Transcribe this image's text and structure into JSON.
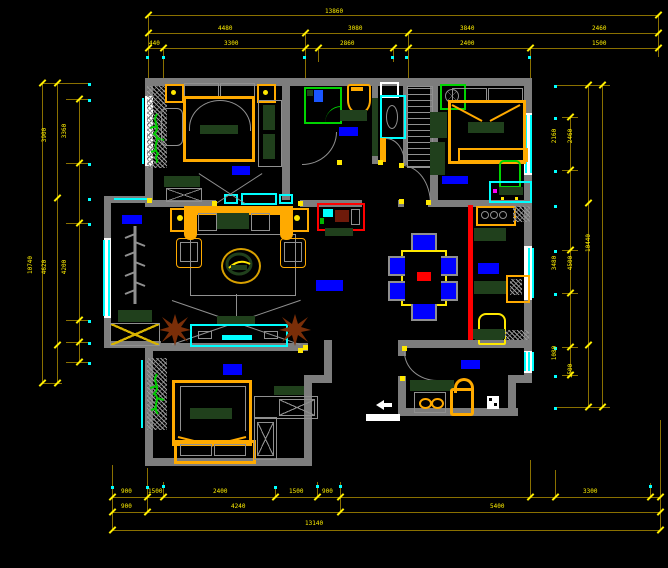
{
  "canvas": {
    "width": 668,
    "height": 568,
    "background": "#000000"
  },
  "drawing_title": "residential-apartment-furniture-floor-plan",
  "colors": {
    "wall": "#7d7d7d",
    "dimension_line": "#8a7000",
    "dimension_text": "#ffef00",
    "window": "#00ffff",
    "room_marker": "#0000ff",
    "cabinet_green": "#20401c",
    "furniture_frame": "#ffaa00",
    "slider_red": "#ff0000",
    "plant_brown": "#7a2e08",
    "plant_green": "#00cc00",
    "white": "#ffffff"
  },
  "rooms": [
    "bedroom-top-left",
    "bathroom",
    "shower-room",
    "closet",
    "bedroom-top-right",
    "balcony",
    "living-room",
    "dining-room",
    "kitchen",
    "bedroom-bottom-left",
    "entry"
  ],
  "markers": [
    {
      "name": "room-marker-bedroom-top-left",
      "x": 232,
      "y": 166,
      "w": 18,
      "h": 9
    },
    {
      "name": "room-marker-bathroom",
      "x": 339,
      "y": 127,
      "w": 19,
      "h": 9
    },
    {
      "name": "room-marker-bedroom-top-right",
      "x": 442,
      "y": 176,
      "w": 26,
      "h": 8
    },
    {
      "name": "room-marker-balcony",
      "x": 122,
      "y": 215,
      "w": 20,
      "h": 9
    },
    {
      "name": "room-marker-living-room",
      "x": 316,
      "y": 280,
      "w": 27,
      "h": 11
    },
    {
      "name": "room-marker-kitchen",
      "x": 478,
      "y": 263,
      "w": 21,
      "h": 11
    },
    {
      "name": "room-marker-bedroom-bottom-left",
      "x": 223,
      "y": 364,
      "w": 19,
      "h": 11
    },
    {
      "name": "room-marker-entry",
      "x": 461,
      "y": 360,
      "w": 19,
      "h": 9
    }
  ],
  "dims": {
    "labels": [
      {
        "text": "13860",
        "x": 325,
        "y": 9
      },
      {
        "text": "4480",
        "x": 218,
        "y": 26
      },
      {
        "text": "3080",
        "x": 348,
        "y": 26
      },
      {
        "text": "3840",
        "x": 460,
        "y": 26
      },
      {
        "text": "2460",
        "x": 592,
        "y": 26
      },
      {
        "text": "440",
        "x": 149,
        "y": 41
      },
      {
        "text": "3300",
        "x": 224,
        "y": 41
      },
      {
        "text": "2860",
        "x": 340,
        "y": 41
      },
      {
        "text": "2400",
        "x": 460,
        "y": 41
      },
      {
        "text": "1500",
        "x": 592,
        "y": 41
      },
      {
        "text": "900",
        "x": 121,
        "y": 489
      },
      {
        "text": "1500",
        "x": 148,
        "y": 489
      },
      {
        "text": "2400",
        "x": 213,
        "y": 489
      },
      {
        "text": "1500",
        "x": 289,
        "y": 489
      },
      {
        "text": "900",
        "x": 322,
        "y": 489
      },
      {
        "text": "3300",
        "x": 583,
        "y": 489
      },
      {
        "text": "900",
        "x": 121,
        "y": 504
      },
      {
        "text": "4240",
        "x": 231,
        "y": 504
      },
      {
        "text": "5400",
        "x": 490,
        "y": 504
      },
      {
        "text": "13140",
        "x": 305,
        "y": 521
      },
      {
        "text": "3900",
        "x": 38,
        "y": 132,
        "rot": -90
      },
      {
        "text": "4620",
        "x": 38,
        "y": 264,
        "rot": -90
      },
      {
        "text": "10740",
        "x": 22,
        "y": 262,
        "rot": -90
      },
      {
        "text": "3360",
        "x": 58,
        "y": 128,
        "rot": -90
      },
      {
        "text": "4200",
        "x": 58,
        "y": 264,
        "rot": -90
      },
      {
        "text": "2160",
        "x": 548,
        "y": 133,
        "rot": -90
      },
      {
        "text": "3480",
        "x": 548,
        "y": 260,
        "rot": -90
      },
      {
        "text": "1080",
        "x": 548,
        "y": 350,
        "rot": -90
      },
      {
        "text": "2460",
        "x": 564,
        "y": 133,
        "rot": -90
      },
      {
        "text": "4500",
        "x": 564,
        "y": 260,
        "rot": -90
      },
      {
        "text": "1500",
        "x": 564,
        "y": 368,
        "rot": -90
      },
      {
        "text": "10440",
        "x": 580,
        "y": 240,
        "rot": -90
      }
    ],
    "ticks": [
      {
        "x": 148,
        "y": 15
      },
      {
        "x": 658,
        "y": 15
      },
      {
        "x": 148,
        "y": 33
      },
      {
        "x": 305,
        "y": 33
      },
      {
        "x": 408,
        "y": 33
      },
      {
        "x": 658,
        "y": 33
      },
      {
        "x": 148,
        "y": 48
      },
      {
        "x": 163,
        "y": 48
      },
      {
        "x": 305,
        "y": 48
      },
      {
        "x": 318,
        "y": 48
      },
      {
        "x": 393,
        "y": 48
      },
      {
        "x": 408,
        "y": 48
      },
      {
        "x": 530,
        "y": 48
      },
      {
        "x": 658,
        "y": 48
      },
      {
        "x": 112,
        "y": 497
      },
      {
        "x": 147,
        "y": 497
      },
      {
        "x": 163,
        "y": 497
      },
      {
        "x": 275,
        "y": 497
      },
      {
        "x": 317,
        "y": 497
      },
      {
        "x": 340,
        "y": 497
      },
      {
        "x": 530,
        "y": 497
      },
      {
        "x": 555,
        "y": 497
      },
      {
        "x": 650,
        "y": 497
      },
      {
        "x": 660,
        "y": 497
      },
      {
        "x": 112,
        "y": 512
      },
      {
        "x": 147,
        "y": 512
      },
      {
        "x": 340,
        "y": 512
      },
      {
        "x": 660,
        "y": 512
      },
      {
        "x": 112,
        "y": 530
      },
      {
        "x": 660,
        "y": 530
      },
      {
        "x": 42,
        "y": 83
      },
      {
        "x": 42,
        "y": 383
      },
      {
        "x": 57,
        "y": 83
      },
      {
        "x": 57,
        "y": 198
      },
      {
        "x": 57,
        "y": 345
      },
      {
        "x": 57,
        "y": 383
      },
      {
        "x": 79,
        "y": 99
      },
      {
        "x": 79,
        "y": 163
      },
      {
        "x": 79,
        "y": 223
      },
      {
        "x": 79,
        "y": 320
      },
      {
        "x": 79,
        "y": 342
      },
      {
        "x": 79,
        "y": 362
      },
      {
        "x": 588,
        "y": 85
      },
      {
        "x": 588,
        "y": 203
      },
      {
        "x": 588,
        "y": 345
      },
      {
        "x": 588,
        "y": 407
      },
      {
        "x": 602,
        "y": 85
      },
      {
        "x": 602,
        "y": 407
      },
      {
        "x": 570,
        "y": 117
      },
      {
        "x": 570,
        "y": 170
      },
      {
        "x": 570,
        "y": 250
      },
      {
        "x": 570,
        "y": 293
      },
      {
        "x": 570,
        "y": 347
      },
      {
        "x": 570,
        "y": 375
      }
    ],
    "dots": [
      {
        "x": 146,
        "y": 56
      },
      {
        "x": 162,
        "y": 56
      },
      {
        "x": 303,
        "y": 56
      },
      {
        "x": 391,
        "y": 56
      },
      {
        "x": 405,
        "y": 56
      },
      {
        "x": 528,
        "y": 56
      },
      {
        "x": 111,
        "y": 486
      },
      {
        "x": 146,
        "y": 486
      },
      {
        "x": 162,
        "y": 485
      },
      {
        "x": 274,
        "y": 486
      },
      {
        "x": 316,
        "y": 485
      },
      {
        "x": 339,
        "y": 485
      },
      {
        "x": 649,
        "y": 485
      },
      {
        "x": 88,
        "y": 83
      },
      {
        "x": 88,
        "y": 99
      },
      {
        "x": 88,
        "y": 163
      },
      {
        "x": 88,
        "y": 198
      },
      {
        "x": 88,
        "y": 223
      },
      {
        "x": 88,
        "y": 320
      },
      {
        "x": 88,
        "y": 342
      },
      {
        "x": 88,
        "y": 362
      },
      {
        "x": 554,
        "y": 85
      },
      {
        "x": 554,
        "y": 117
      },
      {
        "x": 554,
        "y": 170
      },
      {
        "x": 554,
        "y": 205
      },
      {
        "x": 554,
        "y": 250
      },
      {
        "x": 554,
        "y": 293
      },
      {
        "x": 554,
        "y": 347
      },
      {
        "x": 554,
        "y": 375
      },
      {
        "x": 554,
        "y": 407
      }
    ],
    "stubs": [
      {
        "x": 148,
        "y": 15,
        "w": 1,
        "h": 63
      },
      {
        "x": 305,
        "y": 33,
        "w": 1,
        "h": 45
      },
      {
        "x": 408,
        "y": 33,
        "w": 1,
        "h": 45
      },
      {
        "x": 163,
        "y": 48,
        "w": 1,
        "h": 32
      },
      {
        "x": 318,
        "y": 48,
        "w": 1,
        "h": 14
      },
      {
        "x": 393,
        "y": 48,
        "w": 1,
        "h": 14
      },
      {
        "x": 530,
        "y": 48,
        "w": 1,
        "h": 30
      },
      {
        "x": 658,
        "y": 15,
        "w": 1,
        "h": 42
      },
      {
        "x": 112,
        "y": 465,
        "w": 1,
        "h": 65
      },
      {
        "x": 147,
        "y": 468,
        "w": 1,
        "h": 44
      },
      {
        "x": 163,
        "y": 482,
        "w": 1,
        "h": 15
      },
      {
        "x": 275,
        "y": 488,
        "w": 1,
        "h": 9
      },
      {
        "x": 317,
        "y": 482,
        "w": 1,
        "h": 15
      },
      {
        "x": 340,
        "y": 482,
        "w": 1,
        "h": 30
      },
      {
        "x": 530,
        "y": 460,
        "w": 1,
        "h": 37
      },
      {
        "x": 555,
        "y": 470,
        "w": 1,
        "h": 27
      },
      {
        "x": 650,
        "y": 483,
        "w": 1,
        "h": 14
      },
      {
        "x": 660,
        "y": 420,
        "w": 1,
        "h": 110
      },
      {
        "x": 66,
        "y": 99,
        "w": 24,
        "h": 1
      },
      {
        "x": 66,
        "y": 163,
        "w": 24,
        "h": 1
      },
      {
        "x": 66,
        "y": 223,
        "w": 24,
        "h": 1
      },
      {
        "x": 66,
        "y": 320,
        "w": 24,
        "h": 1
      },
      {
        "x": 66,
        "y": 342,
        "w": 24,
        "h": 1
      },
      {
        "x": 66,
        "y": 362,
        "w": 24,
        "h": 1
      },
      {
        "x": 42,
        "y": 83,
        "w": 48,
        "h": 1
      },
      {
        "x": 42,
        "y": 383,
        "w": 20,
        "h": 1
      },
      {
        "x": 562,
        "y": 117,
        "w": 16,
        "h": 1
      },
      {
        "x": 562,
        "y": 170,
        "w": 16,
        "h": 1
      },
      {
        "x": 562,
        "y": 250,
        "w": 16,
        "h": 1
      },
      {
        "x": 562,
        "y": 293,
        "w": 16,
        "h": 1
      },
      {
        "x": 562,
        "y": 347,
        "w": 16,
        "h": 1
      },
      {
        "x": 562,
        "y": 375,
        "w": 16,
        "h": 1
      },
      {
        "x": 554,
        "y": 85,
        "w": 56,
        "h": 1
      },
      {
        "x": 554,
        "y": 407,
        "w": 56,
        "h": 1
      }
    ]
  }
}
